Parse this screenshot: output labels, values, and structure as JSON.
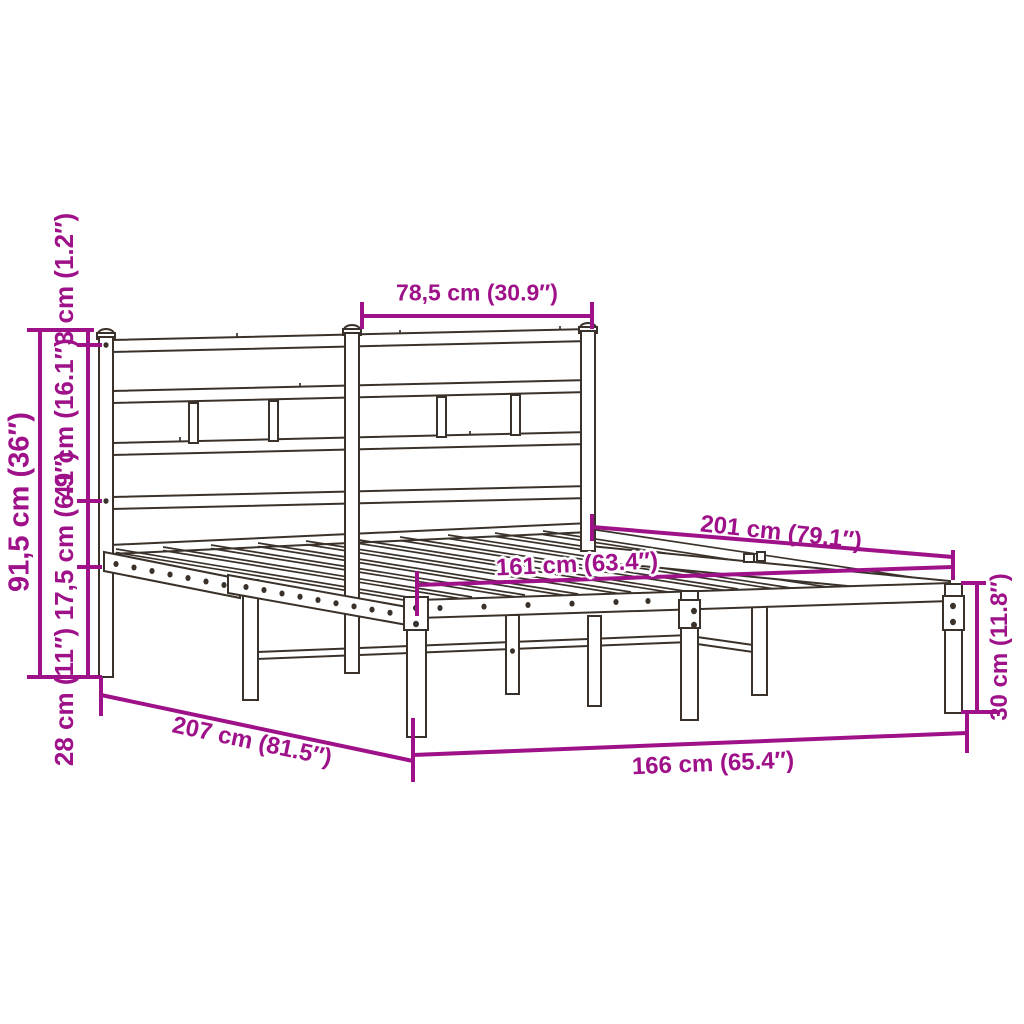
{
  "page": {
    "type": "product-dimension-diagram",
    "subject": "metal bed frame with headboard",
    "background": "#ffffff"
  },
  "colors": {
    "dimension": "#9e1189",
    "drawing": "#3a322a"
  },
  "dimensions": {
    "headboard_section_width": "78,5 cm (30.9″)",
    "headboard_total_height": "91,5 cm (36″)",
    "finial_height": "3 cm (1.2″)",
    "headboard_panel_height": "41 cm (16.1″)",
    "side_rail_depth": "17,5 cm (6.9″)",
    "underbed_clearance": "28 cm (11″)",
    "total_length": "207 cm (81.5″)",
    "total_width": "166 cm (65.4″)",
    "inner_length": "161 cm (63.4″)",
    "frame_length": "201 cm (79.1″)",
    "platform_height": "30 cm (11.8″)"
  }
}
